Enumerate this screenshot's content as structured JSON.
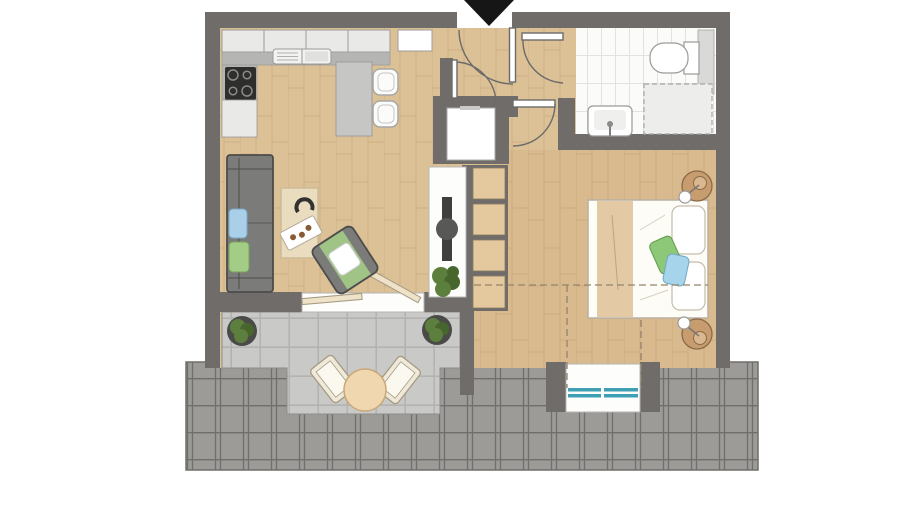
{
  "figure": {
    "kind": "apartment-floor-plan",
    "entrance_marker": "down-arrow",
    "rooms": [
      "kitchen",
      "living-area",
      "hallway",
      "bathroom",
      "bedroom",
      "balcony",
      "roof"
    ],
    "fixtures": [
      "kitchen-cabinets",
      "sink",
      "cooktop",
      "island-with-stools",
      "sofa",
      "rug",
      "armchair",
      "tv-sideboard",
      "utility-closet",
      "shelf-unit",
      "double-bed",
      "nightstand-lamps",
      "toilet",
      "washbasin",
      "shower",
      "balcony-table-set",
      "potted-plants",
      "dormer-window"
    ]
  },
  "colors": {
    "wall": "#6f6c69",
    "wood": "#dcc096",
    "wood-line": "#c3a276",
    "wood-tint": "#c08b4d",
    "bath-tile": "#fbfbf9",
    "bath-line": "#e2e2e0",
    "balcony-tile": "#c9c9c7",
    "balcony-line": "#b3b3b1",
    "roof": "#9d9b98",
    "roof-line": "#716f6c",
    "arrow": "#161616",
    "sofa": "#7b7b79",
    "sofa-line": "#4c4c4a",
    "cushion-blue": "#a9cfe9",
    "cushion-green": "#a3cc86",
    "bed": "#fdfcf7",
    "bed-line": "#b9b0a2",
    "blanket": "#e3c9a4",
    "pillow-green": "#8cc878",
    "pillow-blue": "#a6d4ea",
    "nightstand": "#c79c6f",
    "nightstand-line": "#8a6a48",
    "rug": "#e9dcbf",
    "rug-line": "#cdbb97",
    "counter": "#b5b5b3",
    "cabinet": "#e9e9e7",
    "cabinet-line": "#9c9c9a",
    "island": "#c6c6c4",
    "cooktop": "#2e2e2c",
    "tv": "#3f3f3d",
    "board": "#fdfdfb",
    "shelf": "#e4c99f",
    "shelf-line": "#8a7a60",
    "plant": "#5d7f3d",
    "plant-dark": "#47662e",
    "pot": "#4a4a48",
    "table": "#f0d7b0",
    "table-line": "#c9a878",
    "chair-cream": "#efe9da",
    "chair-line": "#a59a82",
    "window": "#3f9fb5",
    "door-line": "#6b6b69",
    "fixture": "#ffffff",
    "fixture-line": "#9a9a98",
    "shower": "#ededeb",
    "dash": "#93836b",
    "sill": "#fdfdfb",
    "sill-line": "#b5b5b3"
  }
}
